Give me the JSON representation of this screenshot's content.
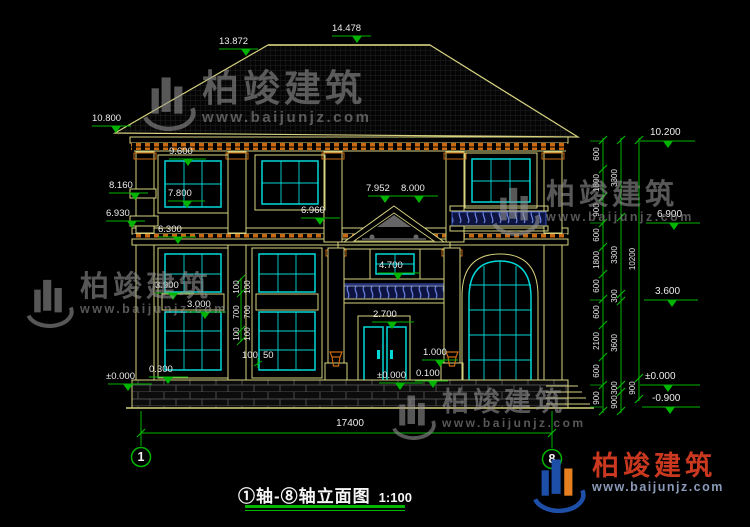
{
  "title": {
    "name": "①轴-⑧轴立面图",
    "scale": "1:100"
  },
  "axes": {
    "start": "1",
    "end": "8"
  },
  "overall": {
    "width": "17400"
  },
  "watermark": {
    "brand": "柏竣建筑",
    "url": "www.baijunjz.com"
  },
  "levels": {
    "ridge": "14.478",
    "roof_break": "13.872",
    "eave_left": "10.800",
    "left": [
      "8.160",
      "6.930"
    ],
    "inner_left": [
      "9.600",
      "7.800",
      "6.300",
      "3.900",
      "3.000",
      "0.300",
      "±0.000"
    ],
    "porch": [
      "7.952",
      "8.000",
      "6.960",
      "4.700",
      "2.700",
      "1.000",
      "±0.000",
      "0.100"
    ],
    "right": [
      "10.200",
      "6.900",
      "3.600",
      "±0.000",
      "-0.900"
    ]
  },
  "chains": {
    "inner": [
      "600",
      "1800",
      "900",
      "600",
      "1800",
      "600",
      "600",
      "2100",
      "600",
      "900"
    ],
    "middle": [
      "3300",
      "3300",
      "300",
      "3600",
      "300",
      "900"
    ],
    "outer": [
      "10200",
      "900"
    ]
  },
  "detail_dims": {
    "vertical": [
      "100",
      "700",
      "100"
    ],
    "horizontal": [
      "100",
      "50"
    ]
  },
  "colors": {
    "line_yellow": "#d6d27f",
    "glazing_cyan": "#00d8d8",
    "dimension_green": "#00b400",
    "accent_orange": "#c96a12",
    "baluster_blue": "#6f86e8"
  }
}
